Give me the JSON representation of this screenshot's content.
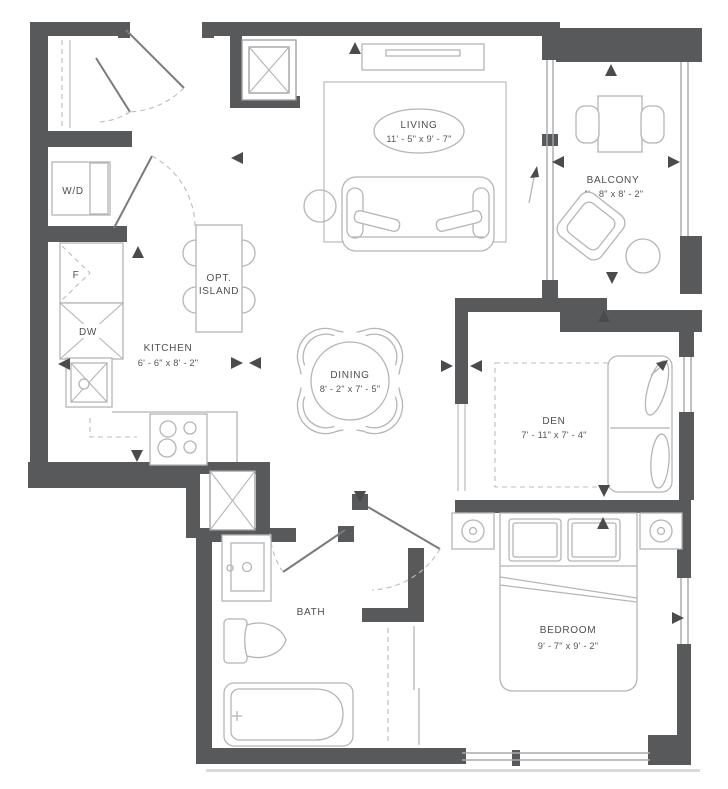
{
  "rooms": {
    "living": {
      "name": "LIVING",
      "dims": "11' - 5\" x 9' - 7\""
    },
    "balcony": {
      "name": "BALCONY",
      "dims": "4' - 8\" x 8' - 2\""
    },
    "kitchen": {
      "name": "KITCHEN",
      "dims": "6' - 6\" x 8' - 2\""
    },
    "dining": {
      "name": "DINING",
      "dims": "8' - 2\" x 7' - 5\""
    },
    "den": {
      "name": "DEN",
      "dims": "7' - 11\" x 7' - 4\""
    },
    "bedroom": {
      "name": "BEDROOM",
      "dims": "9' - 7\" x 9' - 2\""
    },
    "bath": {
      "name": "BATH"
    }
  },
  "fixtures": {
    "island_line1": "OPT.",
    "island_line2": "ISLAND",
    "washer_dryer": "W/D",
    "fridge": "F",
    "dishwasher": "DW"
  },
  "colors": {
    "wall": "#58595b",
    "furniture_line": "#b4b5b7",
    "text": "#4d4e50",
    "background": "#ffffff"
  }
}
